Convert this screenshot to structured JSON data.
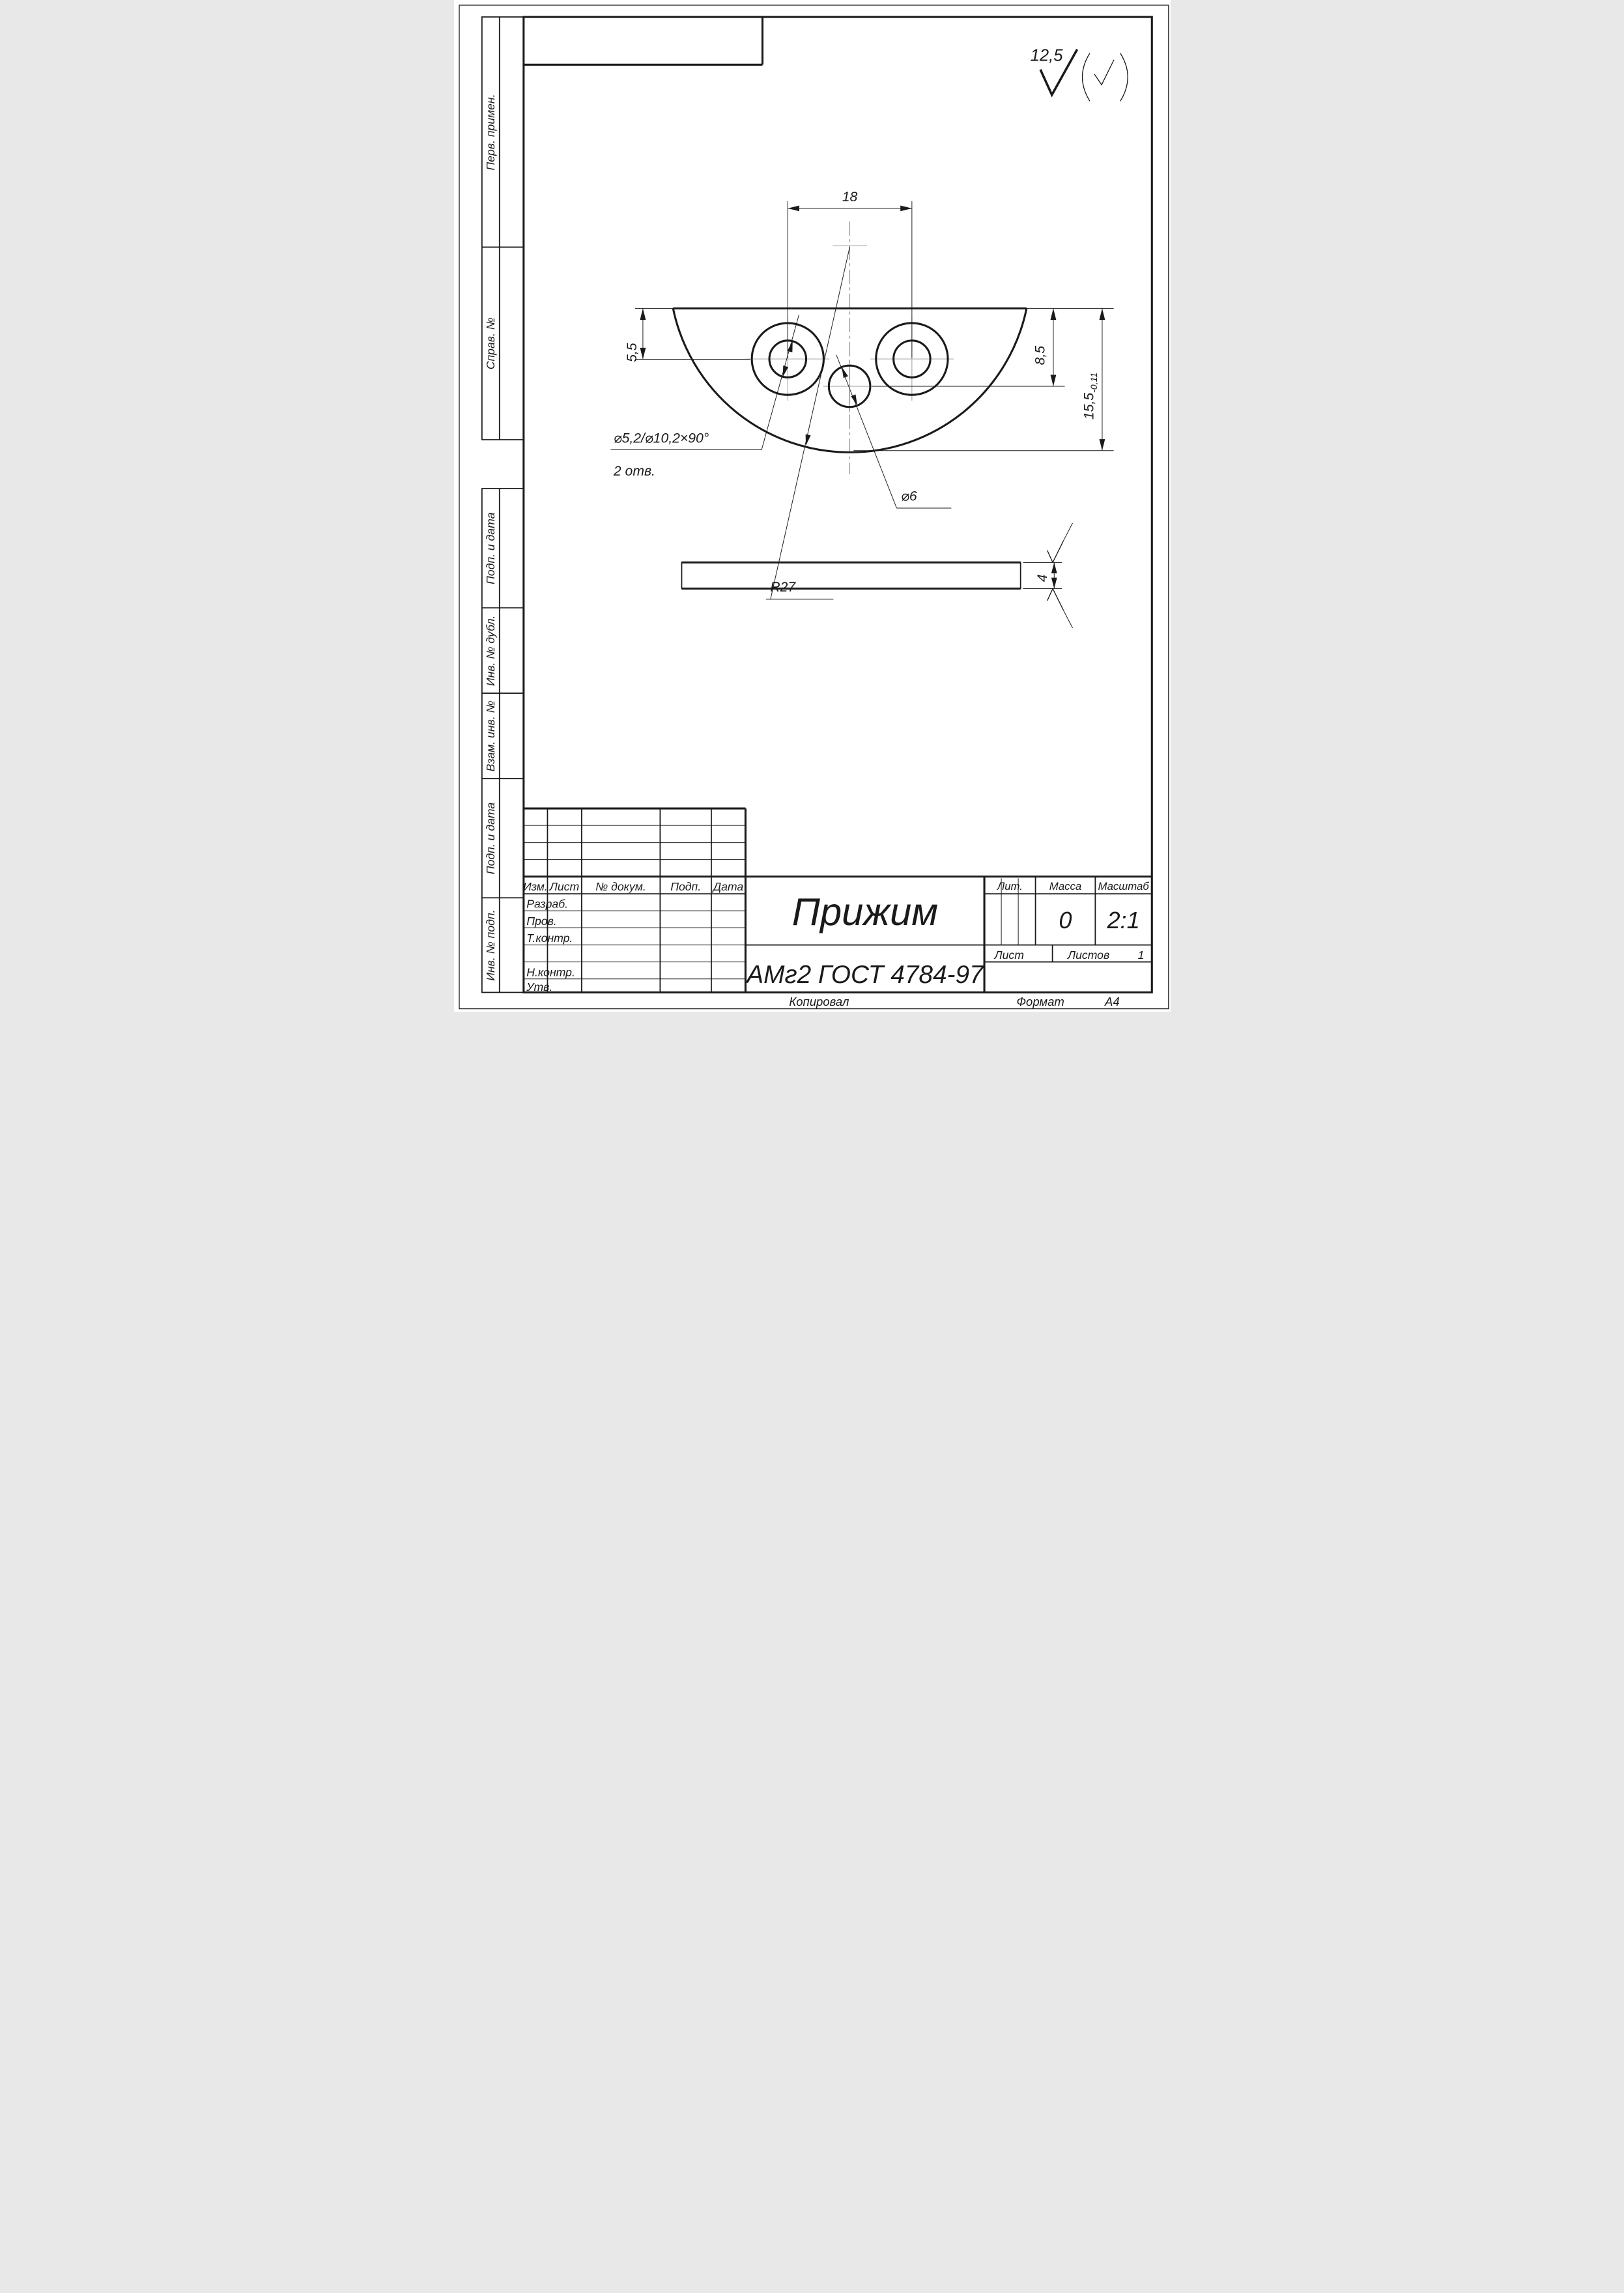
{
  "roughness": {
    "general_value": "12,5"
  },
  "view_main": {
    "dim_hole_centers": "18",
    "dim_top_to_hole_axis": "5,5",
    "dim_top_to_center_hole": "8,5",
    "dim_height": "15,5",
    "dim_height_tolerance": "-0,11",
    "label_counterbore": "⌀5,2/⌀10,2×90°",
    "label_counterbore_qty": "2 отв.",
    "label_center_hole": "⌀6",
    "label_radius": "R27"
  },
  "view_side": {
    "dim_thickness": "4"
  },
  "sidebar": {
    "top": [
      {
        "label": "Перв. примен."
      },
      {
        "label": "Справ. №"
      }
    ],
    "bottom": [
      {
        "label": "Подп. и дата"
      },
      {
        "label": "Инв. № дубл."
      },
      {
        "label": "Взам. инв. №"
      },
      {
        "label": "Подп. и дата"
      },
      {
        "label": "Инв. № подп."
      }
    ]
  },
  "title_block": {
    "rev_headers": {
      "izm": "Изм.",
      "list": "Лист",
      "doc": "№ докум.",
      "sign": "Подп.",
      "date": "Дата"
    },
    "roles": {
      "developed": "Разраб.",
      "checked": "Пров.",
      "tcontrol": "Т.контр.",
      "ncontrol": "Н.контр.",
      "approved": "Утв."
    },
    "part_name": "Прижим",
    "material": "АМг2  ГОСТ 4784-97",
    "lit_label": "Лит.",
    "mass_label": "Масса",
    "scale_label": "Масштаб",
    "mass_value": "0",
    "scale_value": "2:1",
    "sheet_label": "Лист",
    "sheets_label": "Листов",
    "sheets_value": "1"
  },
  "footer": {
    "copied": "Копировал",
    "format_label": "Формат",
    "format_value": "А4"
  }
}
